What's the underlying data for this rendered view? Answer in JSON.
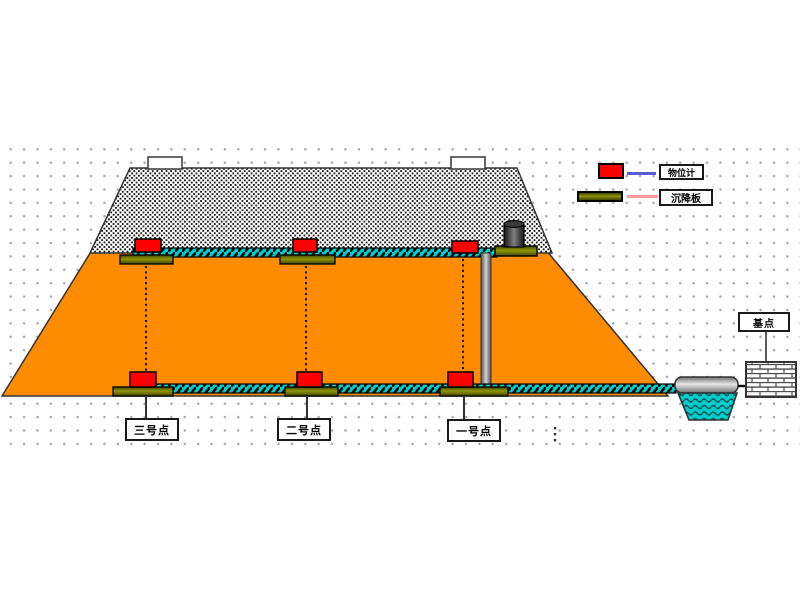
{
  "legend": {
    "items": [
      {
        "label": "物位计",
        "swatch_shape": "red-rectangle",
        "swatch_color": "#FF0000",
        "line_color": "#5B5BD6"
      },
      {
        "label": "沉降板",
        "swatch_shape": "olive-bar",
        "swatch_color": "#6E7000",
        "line_color": "#FF9999"
      }
    ]
  },
  "points": [
    {
      "label": "三号点"
    },
    {
      "label": "二号点"
    },
    {
      "label": "一号点"
    }
  ],
  "datum": {
    "label": "基点"
  },
  "colors": {
    "embankment_fill": "#FF8C00",
    "settlement_tube": "#00CCCC",
    "sensor_red": "#FF0000",
    "plate_olive": "#6E7000",
    "grid_dot": "#A9A9A9",
    "water_pool": "#00CCCC"
  }
}
